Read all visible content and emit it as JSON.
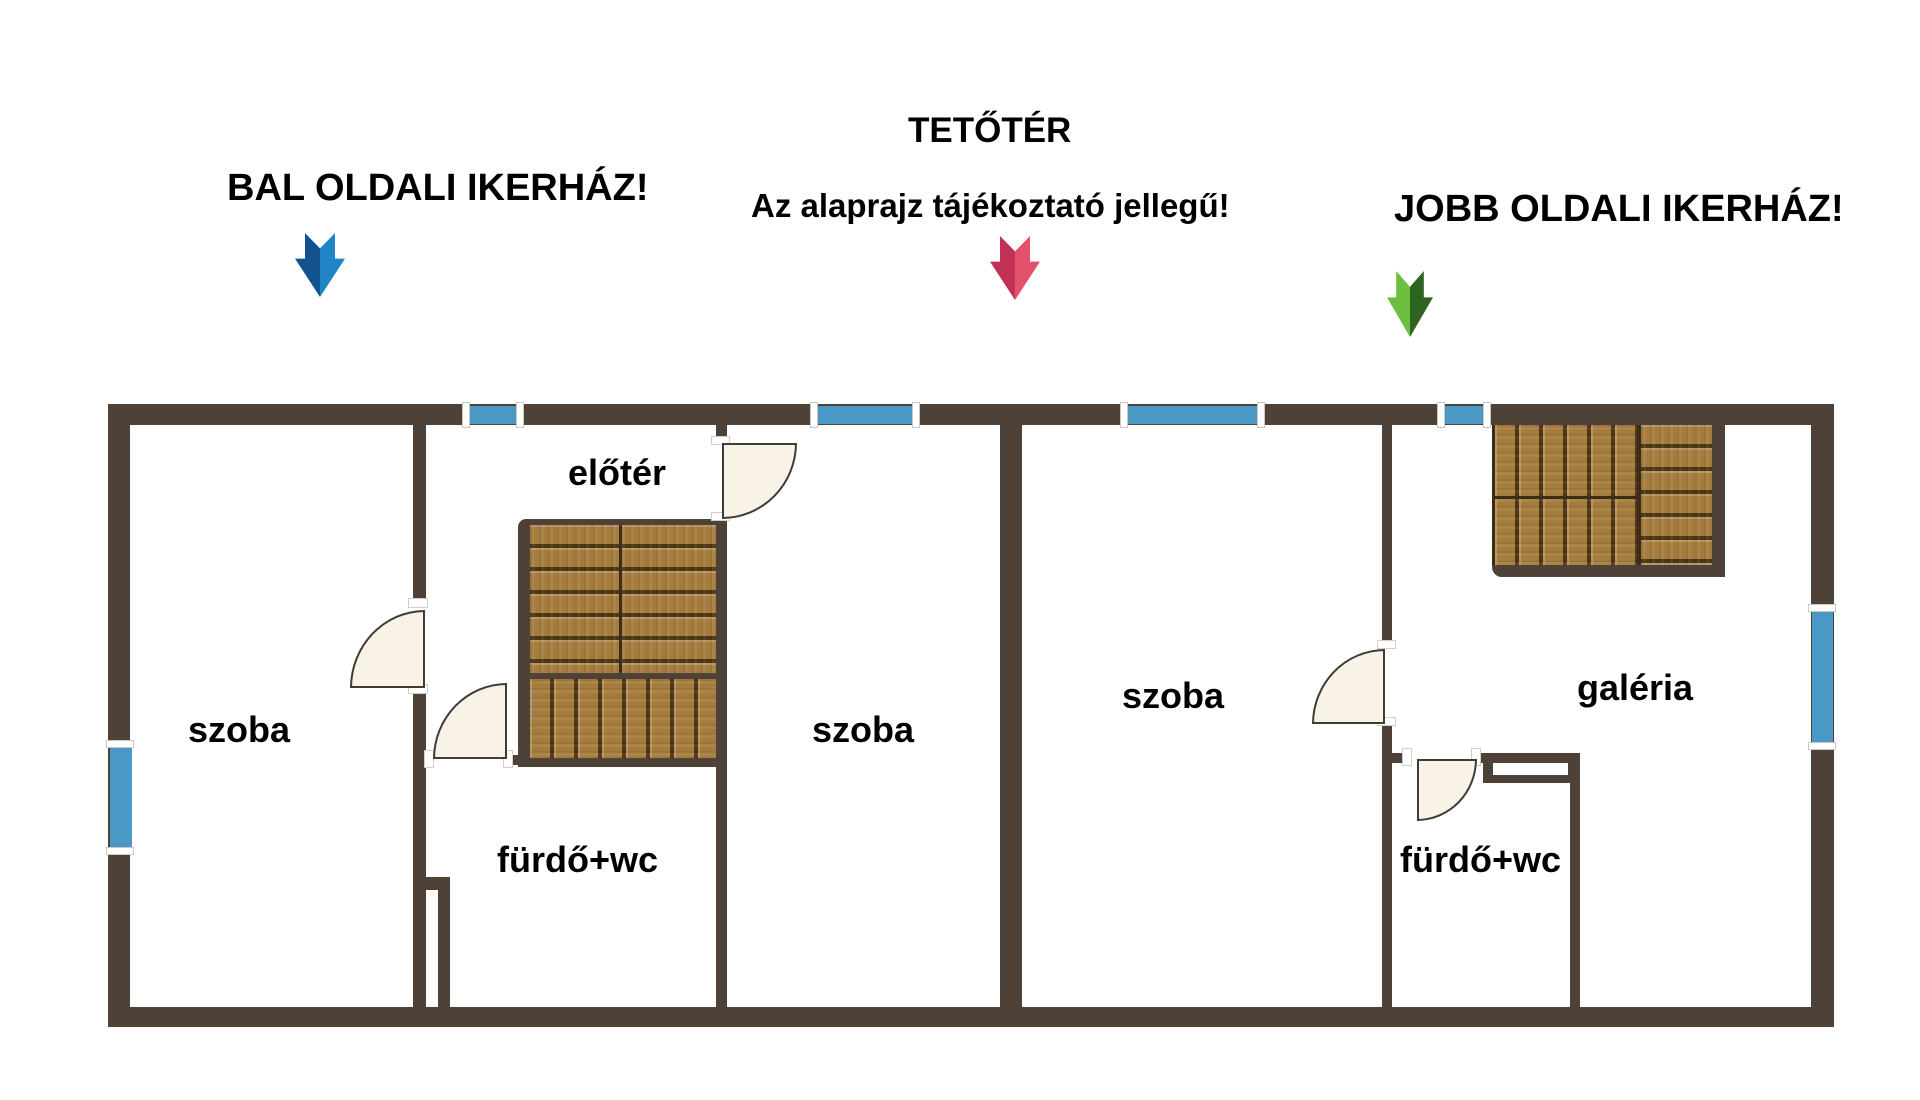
{
  "headings": {
    "left": "BAL OLDALI IKERHÁZ!",
    "title": "TETŐTÉR",
    "subtitle": "Az alaprajz tájékoztató jellegű!",
    "right": "JOBB OLDALI IKERHÁZ!"
  },
  "rooms": {
    "szoba_left": "szoba",
    "eloter": "előtér",
    "szoba_middle": "szoba",
    "furdo_left": "fürdő+wc",
    "szoba_right": "szoba",
    "furdo_right": "fürdő+wc",
    "galeria": "galéria"
  },
  "colors": {
    "wall": "#4d4138",
    "window_blue": "#4a98c6",
    "door_fill": "#f9f2e6",
    "door_border": "#3f3b35",
    "wood": "#a67c3e",
    "wood_line": "#3a2c15",
    "arrow_blue_dark": "#12528f",
    "arrow_blue_light": "#1f85c6",
    "arrow_pink_dark": "#c03154",
    "arrow_pink_light": "#e4516d",
    "arrow_green_light": "#6cbf3e",
    "arrow_green_dark": "#2e6322"
  }
}
